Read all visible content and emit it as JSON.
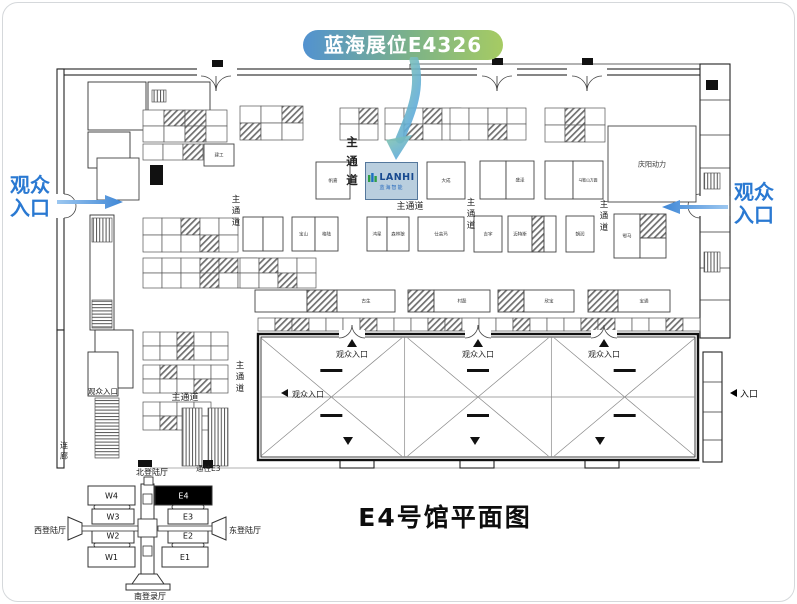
{
  "banner": {
    "text": "蓝海展位E4326"
  },
  "title": {
    "text": "E4号馆平面图"
  },
  "entrances": {
    "left": "观众\n入口",
    "right": "观众\n入口",
    "right_small": "入口"
  },
  "colors": {
    "banner_start": "#5292d0",
    "banner_end": "#a6cb63",
    "entrance_blue": "#2a79d2",
    "arrow_blue": "#4f9ae0",
    "arrow_teal": "#86c7a9",
    "lanhi_fill": "#b9cede",
    "lanhi_text": "#17498f"
  },
  "lanhi": {
    "logo": "LANHI",
    "subtitle": "蓝海智能"
  },
  "plan": {
    "aisle_label": "主通道",
    "corridor_label": "连廊",
    "audience_label": "观众入口",
    "to_e3": "通往E3",
    "v_aisles": [
      {
        "x": 236,
        "y": 202
      },
      {
        "x": 352,
        "y": 146,
        "big": true
      },
      {
        "x": 471,
        "y": 205
      },
      {
        "x": 604,
        "y": 207
      },
      {
        "x": 240,
        "y": 368
      }
    ],
    "h_aisles": [
      {
        "x": 410,
        "y": 209
      },
      {
        "x": 185,
        "y": 400
      },
      {
        "x": 103,
        "y": 394,
        "audience": true,
        "small": true
      }
    ],
    "clusters": [
      {
        "x": 143,
        "y": 110,
        "cols": 4,
        "rows": 2,
        "cw": 21,
        "ch": 16,
        "hatch": [
          1,
          2,
          6
        ]
      },
      {
        "x": 240,
        "y": 106,
        "cols": 3,
        "rows": 2,
        "cw": 21,
        "ch": 17,
        "hatch": [
          2,
          3
        ]
      },
      {
        "x": 143,
        "y": 144,
        "cols": 3,
        "rows": 1,
        "cw": 20,
        "ch": 16,
        "hatch": [
          2
        ]
      },
      {
        "x": 340,
        "y": 108,
        "cols": 2,
        "rows": 2,
        "cw": 19,
        "ch": 16,
        "hatch": [
          1
        ]
      },
      {
        "x": 385,
        "y": 108,
        "cols": 4,
        "rows": 2,
        "cw": 19,
        "ch": 16,
        "hatch": [
          2,
          5
        ]
      },
      {
        "x": 450,
        "y": 108,
        "cols": 4,
        "rows": 2,
        "cw": 19,
        "ch": 16,
        "hatch": [
          6
        ]
      },
      {
        "x": 545,
        "y": 108,
        "cols": 3,
        "rows": 2,
        "cw": 20,
        "ch": 17,
        "hatch": [
          1,
          4
        ]
      },
      {
        "x": 143,
        "y": 218,
        "cols": 5,
        "rows": 2,
        "cw": 19,
        "ch": 17,
        "hatch": [
          2,
          8
        ]
      },
      {
        "x": 143,
        "y": 258,
        "cols": 6,
        "rows": 2,
        "cw": 19,
        "ch": 15,
        "hatch": [
          3,
          4,
          9
        ]
      },
      {
        "x": 240,
        "y": 258,
        "cols": 4,
        "rows": 2,
        "cw": 19,
        "ch": 15,
        "hatch": [
          1,
          6
        ]
      },
      {
        "x": 143,
        "y": 332,
        "cols": 5,
        "rows": 2,
        "cw": 17,
        "ch": 14,
        "hatch": [
          2,
          7
        ]
      },
      {
        "x": 143,
        "y": 365,
        "cols": 5,
        "rows": 2,
        "cw": 17,
        "ch": 14,
        "hatch": [
          1,
          8
        ]
      },
      {
        "x": 143,
        "y": 402,
        "cols": 4,
        "rows": 2,
        "cw": 17,
        "ch": 14,
        "hatch": [
          5
        ]
      }
    ],
    "top_strip": {
      "x": 258,
      "y": 318,
      "cols": 26,
      "cw": 17,
      "ch": 13,
      "hatch": [
        1,
        2,
        6,
        10,
        11,
        15,
        19,
        20,
        24
      ]
    },
    "booths": [
      {
        "x": 97,
        "y": 158,
        "w": 42,
        "h": 42,
        "label": ""
      },
      {
        "x": 204,
        "y": 144,
        "w": 30,
        "h": 22,
        "label": "建工"
      },
      {
        "x": 316,
        "y": 162,
        "w": 34,
        "h": 37,
        "label": "帆嘉"
      },
      {
        "x": 427,
        "y": 162,
        "w": 38,
        "h": 37,
        "label": "大成"
      },
      {
        "x": 480,
        "y": 161,
        "w": 26,
        "h": 38,
        "label": ""
      },
      {
        "x": 506,
        "y": 161,
        "w": 28,
        "h": 38,
        "label": "盛泽"
      },
      {
        "x": 545,
        "y": 161,
        "w": 28,
        "h": 38,
        "label": ""
      },
      {
        "x": 573,
        "y": 161,
        "w": 30,
        "h": 38,
        "label": "马鞍山方圆",
        "fs": 3.8
      },
      {
        "x": 608,
        "y": 126,
        "w": 88,
        "h": 76,
        "label": "庆阳动力",
        "fs": 7
      },
      {
        "x": 243,
        "y": 217,
        "w": 20,
        "h": 34,
        "label": ""
      },
      {
        "x": 263,
        "y": 217,
        "w": 20,
        "h": 34,
        "label": ""
      },
      {
        "x": 292,
        "y": 217,
        "w": 23,
        "h": 34,
        "label": "宝山"
      },
      {
        "x": 315,
        "y": 217,
        "w": 23,
        "h": 34,
        "label": "格陆"
      },
      {
        "x": 367,
        "y": 217,
        "w": 20,
        "h": 34,
        "label": "鸿星"
      },
      {
        "x": 387,
        "y": 217,
        "w": 22,
        "h": 34,
        "label": "森林狼"
      },
      {
        "x": 418,
        "y": 217,
        "w": 46,
        "h": 34,
        "label": "仕高玛"
      },
      {
        "x": 474,
        "y": 216,
        "w": 28,
        "h": 36,
        "label": "吉宇"
      },
      {
        "x": 508,
        "y": 216,
        "w": 24,
        "h": 36,
        "label": "迈特斯"
      },
      {
        "x": 532,
        "y": 216,
        "w": 12,
        "h": 36,
        "hatch": true
      },
      {
        "x": 544,
        "y": 216,
        "w": 12,
        "h": 36,
        "label": ""
      },
      {
        "x": 566,
        "y": 216,
        "w": 28,
        "h": 36,
        "label": "朝润"
      },
      {
        "x": 614,
        "y": 214,
        "w": 26,
        "h": 44,
        "label": "鄂马"
      },
      {
        "x": 640,
        "y": 214,
        "w": 26,
        "h": 24,
        "hatch": true
      },
      {
        "x": 640,
        "y": 238,
        "w": 26,
        "h": 20,
        "label": ""
      },
      {
        "x": 255,
        "y": 290,
        "w": 52,
        "h": 22,
        "label": ""
      },
      {
        "x": 307,
        "y": 290,
        "w": 30,
        "h": 22,
        "hatch": true
      },
      {
        "x": 337,
        "y": 290,
        "w": 58,
        "h": 22,
        "label": "古生"
      },
      {
        "x": 408,
        "y": 290,
        "w": 26,
        "h": 22,
        "hatch": true
      },
      {
        "x": 434,
        "y": 290,
        "w": 56,
        "h": 22,
        "label": "村磊"
      },
      {
        "x": 498,
        "y": 290,
        "w": 26,
        "h": 22,
        "hatch": true
      },
      {
        "x": 524,
        "y": 290,
        "w": 50,
        "h": 22,
        "label": "欣宝"
      },
      {
        "x": 588,
        "y": 290,
        "w": 30,
        "h": 22,
        "hatch": true
      },
      {
        "x": 618,
        "y": 290,
        "w": 52,
        "h": 22,
        "label": "宝通"
      }
    ],
    "stairs": [
      {
        "x": 92,
        "y": 218,
        "w": 20,
        "h": 24,
        "pat": "v"
      },
      {
        "x": 92,
        "y": 300,
        "w": 20,
        "h": 28,
        "pat": "h"
      },
      {
        "x": 95,
        "y": 398,
        "w": 24,
        "h": 60,
        "pat": "h"
      },
      {
        "x": 182,
        "y": 408,
        "w": 20,
        "h": 58,
        "pat": "v"
      },
      {
        "x": 208,
        "y": 408,
        "w": 20,
        "h": 58,
        "pat": "v"
      },
      {
        "x": 704,
        "y": 173,
        "w": 16,
        "h": 16,
        "pat": "v"
      },
      {
        "x": 704,
        "y": 252,
        "w": 16,
        "h": 20,
        "pat": "v"
      },
      {
        "x": 152,
        "y": 90,
        "w": 14,
        "h": 12,
        "pat": "v"
      }
    ],
    "bits": [
      {
        "x": 212,
        "y": 60,
        "w": 11,
        "h": 7
      },
      {
        "x": 492,
        "y": 58,
        "w": 11,
        "h": 7
      },
      {
        "x": 582,
        "y": 58,
        "w": 11,
        "h": 7
      },
      {
        "x": 150,
        "y": 165,
        "w": 13,
        "h": 20
      },
      {
        "x": 706,
        "y": 80,
        "w": 12,
        "h": 10
      },
      {
        "x": 138,
        "y": 460,
        "w": 14,
        "h": 7
      },
      {
        "x": 203,
        "y": 460,
        "w": 10,
        "h": 8
      }
    ],
    "hall": {
      "x": 258,
      "y": 334,
      "w": 440,
      "h": 126,
      "bays": 3,
      "top_entrances": [
        352,
        478,
        604
      ],
      "left_entrance": {
        "x": 288,
        "y": 397
      },
      "bottom_marks": [
        348,
        475,
        600
      ]
    }
  },
  "inset": {
    "north_hall": "北登陆厅",
    "south_hall": "南登录厅",
    "west_hall": "西登陆厅",
    "east_hall": "东登陆厅",
    "west_blocks": [
      "W4",
      "W3",
      "W2",
      "W1"
    ],
    "east_blocks": [
      "E4",
      "E3",
      "E2",
      "E1"
    ],
    "highlighted": "E4"
  }
}
